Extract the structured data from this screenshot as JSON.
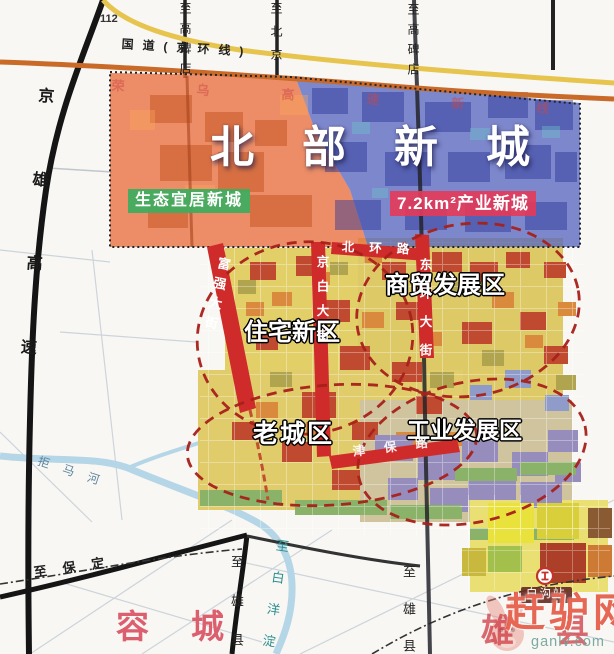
{
  "colors": {
    "north_city_orange_overlay": "#e8703f",
    "north_city_blue_overlay": "#5a68bf",
    "eco_badge_green": "#3cac5e",
    "industry_badge_red": "#e23b5a",
    "city_road_red": "#cf2b2b",
    "zone_circle_dashed_red": "#a8201a",
    "national_road_yellow": "#e6c44e",
    "expressway_orange": "#c96a28",
    "watermark_red": "#e0452e"
  },
  "top_labels": {
    "route_112": "112",
    "national_road": "国道(京环线)",
    "to_gaobeidian_left": "至高碑店",
    "to_beijing": "至北京",
    "to_gaobeidian_right": "至高碑店"
  },
  "west_labels": {
    "jingxiong_expressway": "京雄高速"
  },
  "north_new_city": {
    "title": "北部新城",
    "eco_badge": "生态宜居新城",
    "industry_badge": "7.2km²产业新城",
    "rongwu_expressway": "荣乌高速新线"
  },
  "zones": {
    "residential": "住宅新区",
    "commerce": "商贸发展区",
    "old_town": "老城区",
    "industrial": "工业发展区"
  },
  "city_roads": {
    "fuqiang_street": "富强大街",
    "jingbai_street": "京白大街",
    "beihuan_road": "北环路",
    "donghuan_street": "东环大街",
    "jinbao_road": "津保路"
  },
  "south_labels": {
    "to_baoding": "至保定",
    "to_xiongxian_west": "至雄县",
    "to_xiongxian_east": "至雄县",
    "to_baiyangdian": "至白洋淀",
    "juma_river": "拒马河",
    "rongcheng_county": "容城",
    "xiong_county": "雄县",
    "baigou_station": "白沟站"
  },
  "watermark": {
    "site_name": "赶驴网",
    "site_url": "ganlv.com"
  }
}
